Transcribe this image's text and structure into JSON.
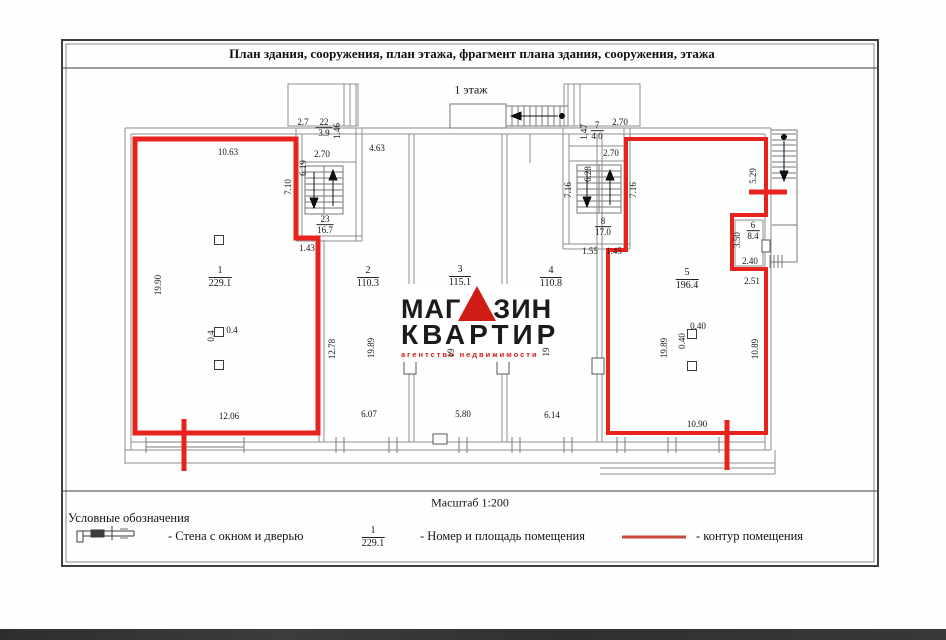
{
  "title": "План здания, сооружения, план этажа, фрагмент плана здания, сооружения, этажа",
  "floor_label": "1 этаж",
  "scale_label": "Масштаб 1:200",
  "rooms": {
    "r1": {
      "num": "1",
      "area": "229.1"
    },
    "r2": {
      "num": "2",
      "area": "110.3"
    },
    "r3": {
      "num": "3",
      "area": "115.1"
    },
    "r4": {
      "num": "4",
      "area": "110.8"
    },
    "r5": {
      "num": "5",
      "area": "196.4"
    },
    "r6": {
      "num": "6",
      "area": "8.4"
    },
    "r7": {
      "num": "7",
      "area": "4.0"
    },
    "r8": {
      "num": "8",
      "area": "17.0"
    },
    "r22": {
      "num": "22",
      "area": "3.9"
    },
    "r23": {
      "num": "23",
      "area": "16.7"
    }
  },
  "dims": {
    "room1_top": "10.63",
    "room1_left": "19.90",
    "room1_bottom": "12.06",
    "room1_col_w": "0.4",
    "room1_col_h": "0.4",
    "room1_step": "1.43",
    "lsw_top_width": "2.7",
    "lsw_top_right": "1.46",
    "lsw_width": "2.70",
    "lsw_height": "6.19",
    "lsw_left": "7.10",
    "room2_top": "4.63",
    "room2_wall_left": "12.78",
    "room2_left": "19.89",
    "room2_bottom": "6.07",
    "room3_left": "19",
    "room3_bottom": "5.80",
    "room4_left": "19",
    "room4_bottom": "6.14",
    "rsw_top_left": "1.47",
    "rsw_top_width": "2.70",
    "rsw_width": "2.70",
    "rsw_height": "6.28",
    "rsw_left": "7.16",
    "rsw_right": "7.16",
    "rsw_bottom_left": "1.55",
    "rsw_bottom_right": "1.45",
    "room5_left": "19.89",
    "room5_col_w": "0.40",
    "room5_col_h": "0.40",
    "room5_bottom": "10.90",
    "room5_right": "10.89",
    "ext_stair": "5.29",
    "room6_left": "3.50",
    "room6_bottom": "2.40",
    "room6_below": "2.51"
  },
  "legend": {
    "heading": "Условные обозначения",
    "wall_label": "- Стена с окном и дверью",
    "sample_num": "1",
    "sample_area": "229.1",
    "number_label": "- Номер и площадь помещения",
    "contour_label": "- контур помещения"
  },
  "watermark": {
    "part1": "МАГ",
    "part2": "ЗИН",
    "line2": "КВАРТИР",
    "tagline": "агентство недвижимости"
  },
  "colors": {
    "contour_red": "#e8231d",
    "legend_red": "#c9493f",
    "wall_gray": "#8f8f8f",
    "logo_red": "#cf1d15"
  }
}
